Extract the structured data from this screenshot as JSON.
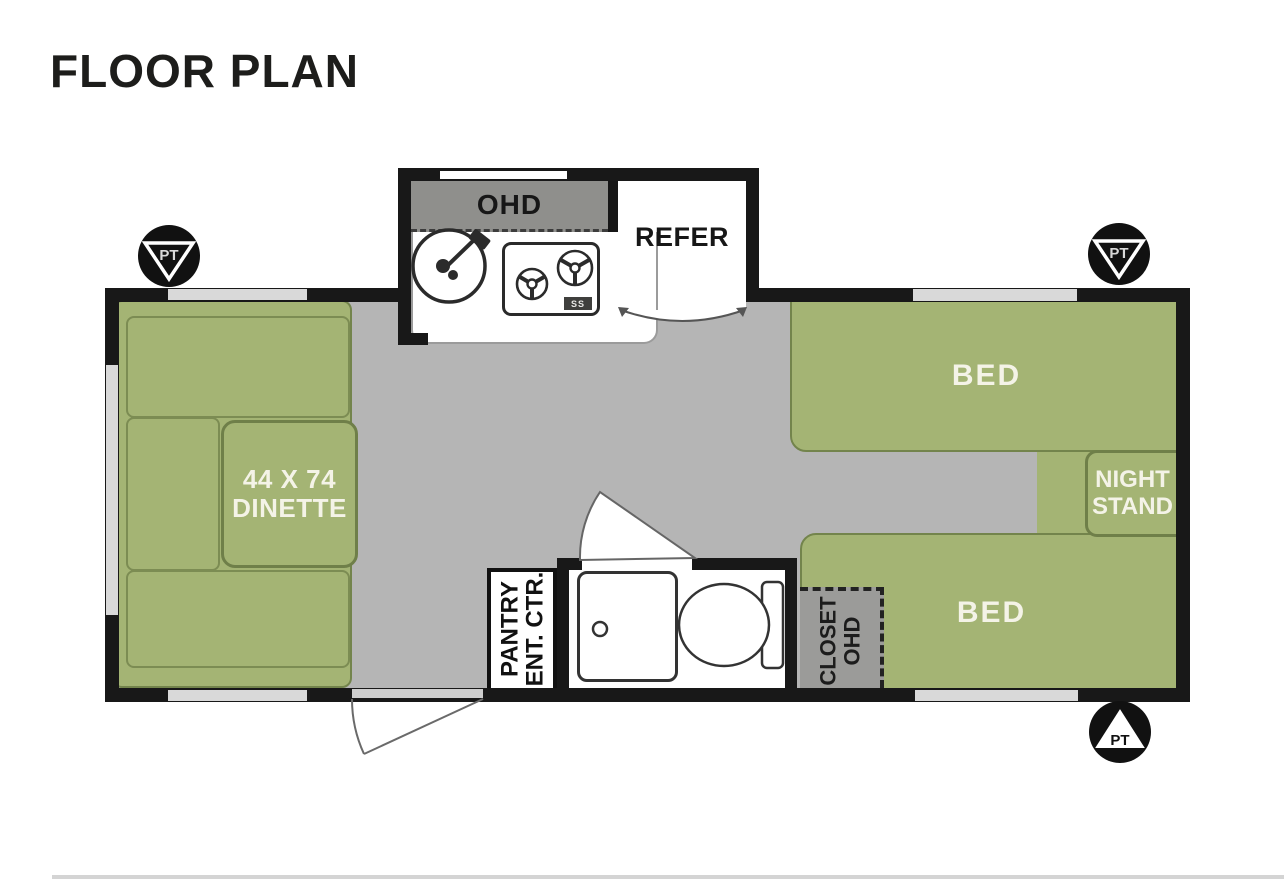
{
  "page": {
    "title": "FLOOR PLAN"
  },
  "colors": {
    "furniture_green": "#a4b474",
    "green_outline": "#73844c",
    "floor_gray": "#b5b5b5",
    "wall_black": "#181818",
    "overhead_band_gray": "#8f8f8c",
    "closet_gray": "#9b9b99",
    "window_gray": "#d9d9d9",
    "label_white": "#f4f3e7"
  },
  "plan": {
    "kitchen": {
      "overhead_label": "OHD",
      "fridge_label": "REFER",
      "stove_badge": "SS"
    },
    "dinette": {
      "line1": "44 X 74",
      "line2": "DINETTE"
    },
    "bed_front": {
      "label": "BED"
    },
    "bed_rear": {
      "label": "BED"
    },
    "nightstand": {
      "line1": "NIGHT",
      "line2": "STAND"
    },
    "pantry": {
      "line1": "PANTRY",
      "line2": "ENT. CTR."
    },
    "closet": {
      "line1": "CLOSET",
      "line2": "OHD"
    },
    "pt_markers": [
      {
        "label": "PT"
      },
      {
        "label": "PT"
      },
      {
        "label": "PT"
      }
    ]
  }
}
